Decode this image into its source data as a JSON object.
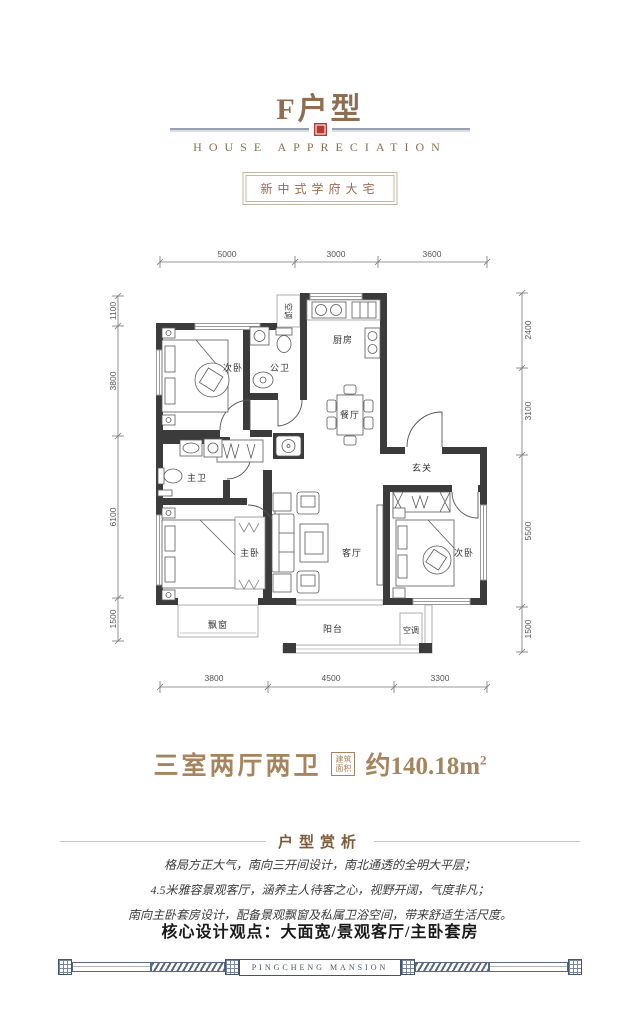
{
  "header": {
    "title": "F户型",
    "subtitle": "HOUSE APPRECIATION",
    "badge": "新中式学府大宅"
  },
  "plan": {
    "room_labels": {
      "bedroom_top": "次卧",
      "public_bath": "公卫",
      "kitchen": "厨房",
      "dining": "餐厅",
      "foyer": "玄关",
      "master_bath": "主卫",
      "master_bedroom": "主卧",
      "living": "客厅",
      "bedroom_right": "次卧",
      "bay_window": "飘窗",
      "balcony": "阳台",
      "ac_top": "空调",
      "ac_bottom": "空调"
    },
    "dims": {
      "top": [
        "5000",
        "3000",
        "3600"
      ],
      "bottom": [
        "3800",
        "4500",
        "3300"
      ],
      "left": [
        "1100",
        "3800",
        "6100",
        "1500"
      ],
      "right": [
        "2400",
        "3100",
        "5500",
        "1500"
      ]
    }
  },
  "summary": {
    "layout_text": "三室两厅两卫",
    "area_tag_l1": "建筑",
    "area_tag_l2": "面积",
    "area_value": "约140.18m",
    "area_exp": "2"
  },
  "analysis": {
    "title": "户型赏析",
    "line1": "格局方正大气，南向三开间设计，南北通透的全明大平层；",
    "line2": "4.5米雅容景观客厅，涵养主人待客之心，视野开阔，气度非凡；",
    "line3": "南向主卧套房设计，配备景观飘窗及私属卫浴空间，带来舒适生活尺度。",
    "keypoint": "核心设计观点：大面宽/景观客厅/主卧套房"
  },
  "footer": {
    "brand": "PINGCHENG MANSION"
  }
}
